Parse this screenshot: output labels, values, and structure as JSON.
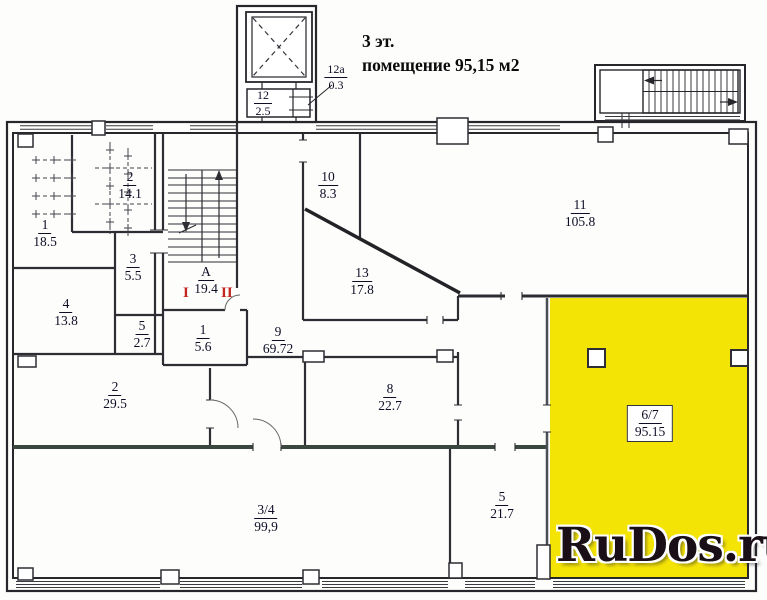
{
  "title": {
    "line1": "3 эт.",
    "line2": "помещение 95,15 м2"
  },
  "watermark": {
    "text": "RuDos.ru"
  },
  "colors": {
    "highlight": "#f4e405",
    "wall": "#26262b",
    "stair_mark_red": "#c3241f"
  },
  "stair_marks": {
    "left": "I",
    "right": "II"
  },
  "rooms": [
    {
      "number": "1",
      "area": "18.5"
    },
    {
      "number": "2",
      "area": "14.1"
    },
    {
      "number": "3",
      "area": "5.5"
    },
    {
      "number": "4",
      "area": "13.8"
    },
    {
      "number": "5",
      "area": "2.7"
    },
    {
      "number": "А",
      "area": "19.4"
    },
    {
      "number": "1",
      "area": "5.6"
    },
    {
      "number": "9",
      "area": "69.72"
    },
    {
      "number": "2",
      "area": "29.5"
    },
    {
      "number": "8",
      "area": "22.7"
    },
    {
      "number": "3/4",
      "area": "99,9"
    },
    {
      "number": "5",
      "area": "21.7"
    },
    {
      "number": "10",
      "area": "8.3"
    },
    {
      "number": "13",
      "area": "17.8"
    },
    {
      "number": "11",
      "area": "105.8"
    },
    {
      "number": "6/7",
      "area": "95.15",
      "highlighted": true
    },
    {
      "number": "12",
      "area": "2.5"
    },
    {
      "number": "12а",
      "area": "0.3"
    }
  ]
}
